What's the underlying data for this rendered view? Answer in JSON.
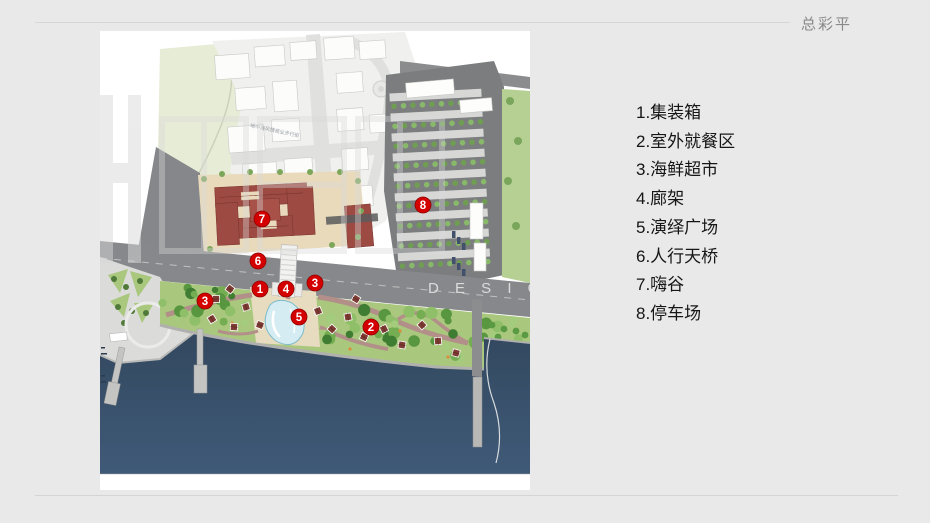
{
  "slide": {
    "title": "总彩平"
  },
  "legend": {
    "items": [
      "1.集装箱",
      "2.室外就餐区",
      "3.海鲜超市",
      "4.廊架",
      "5.演绎广场",
      "6.人行天桥",
      "7.嗨谷",
      "8.停车场"
    ]
  },
  "map": {
    "street_label": "地中海风情商业步行街",
    "watermark_en": "D E S I G N",
    "markers": [
      {
        "num": "1",
        "x": 160,
        "y": 258
      },
      {
        "num": "2",
        "x": 271,
        "y": 296
      },
      {
        "num": "3",
        "x": 105,
        "y": 270
      },
      {
        "num": "3",
        "x": 215,
        "y": 252
      },
      {
        "num": "4",
        "x": 186,
        "y": 258
      },
      {
        "num": "5",
        "x": 199,
        "y": 286
      },
      {
        "num": "6",
        "x": 158,
        "y": 230
      },
      {
        "num": "7",
        "x": 162,
        "y": 188
      },
      {
        "num": "8",
        "x": 323,
        "y": 174
      }
    ],
    "colors": {
      "marker": "#d40000",
      "marker_ring": "#8f0000",
      "water_top": "#33485f",
      "water_bottom": "#3f5a78",
      "park": "#a9c87e",
      "field": "#e6ecd6",
      "road": "#86888b",
      "asphalt": "#7b7d7f",
      "red_building": "#9c4a42",
      "plaza_beige": "#e9dabc",
      "tree_palette": [
        "#3f7d33",
        "#58963f",
        "#74ad52",
        "#8fbf68",
        "#a3cc7c"
      ],
      "parking_trees": [
        "#6f9e52",
        "#88b86a"
      ],
      "cottage": "#7d3b33"
    }
  }
}
